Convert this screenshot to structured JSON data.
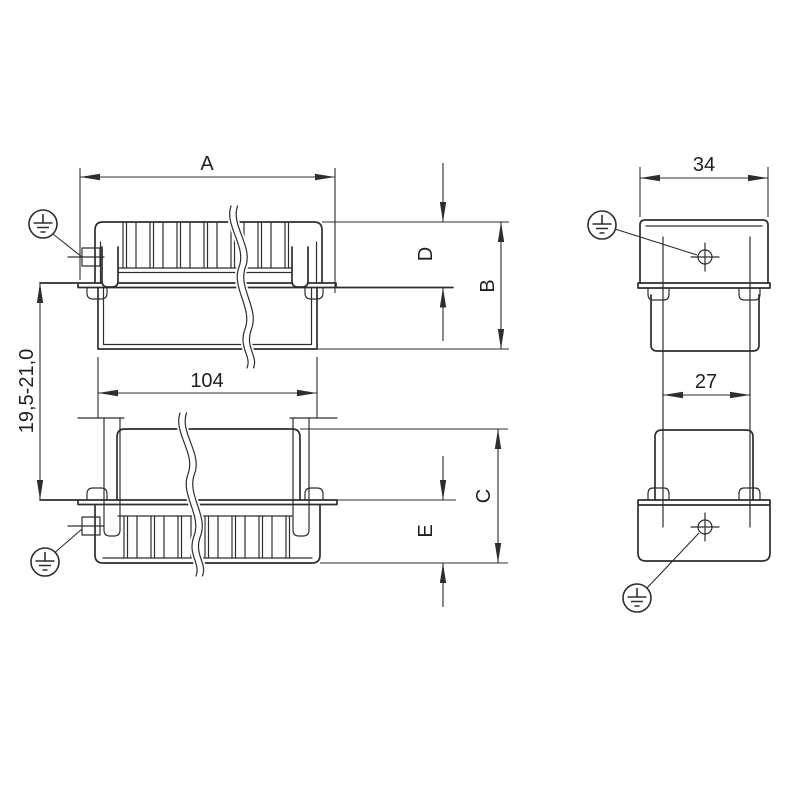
{
  "drawing": {
    "type": "connector-dimension-drawing",
    "front_view": {
      "dim_a_label": "A",
      "dim_width_label": "104",
      "dim_spacing_label": "19,5-21,0",
      "dim_d_label": "D",
      "dim_b_label": "B",
      "dim_c_label": "C",
      "dim_e_label": "E"
    },
    "side_view": {
      "dim_width_label": "34",
      "dim_inner_label": "27"
    },
    "icons": {
      "earth": "protective-earth-icon",
      "target": "crosshair-target-icon"
    },
    "colors": {
      "line": "#2e2e2e",
      "text": "#1f1f1f",
      "background": "#ffffff"
    }
  }
}
